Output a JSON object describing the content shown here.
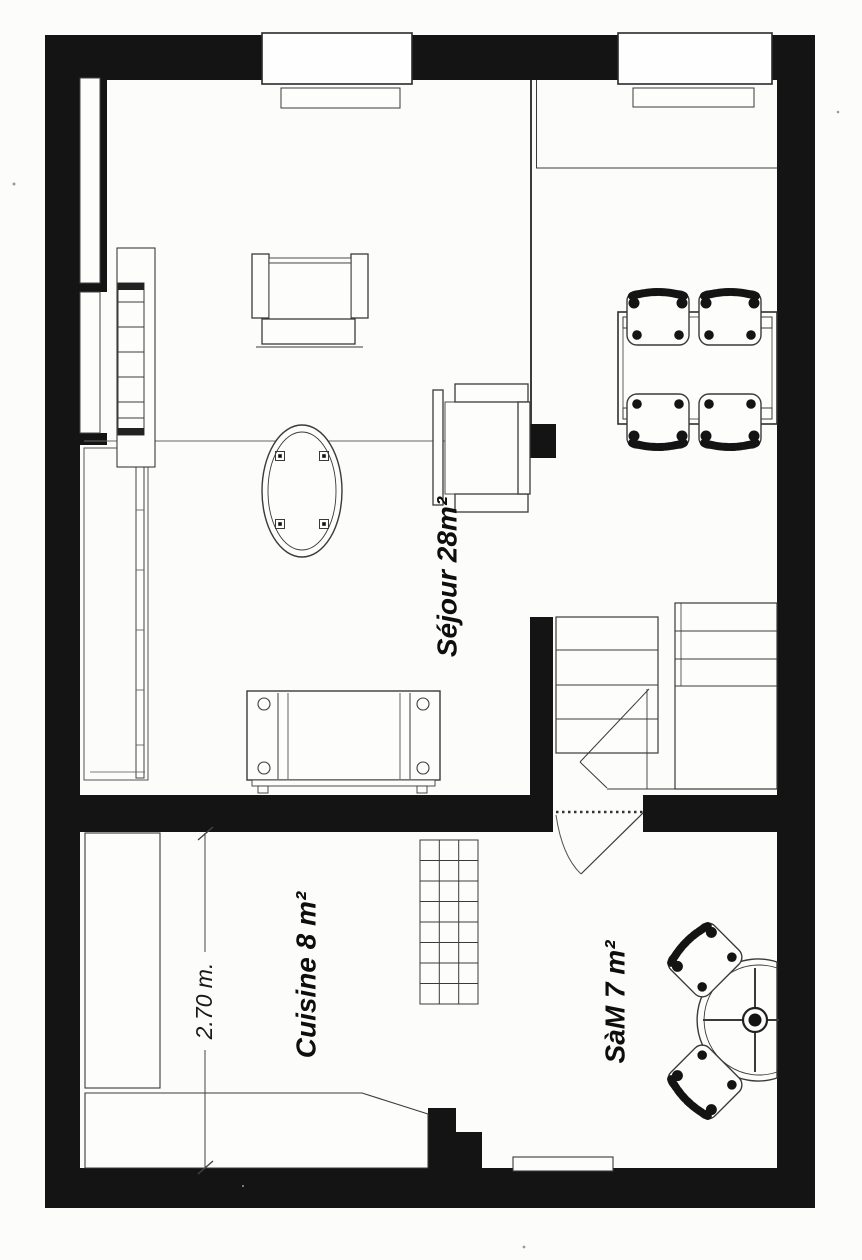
{
  "document": {
    "type": "architectural floor plan (scanned)",
    "ink_color": "#141414",
    "paper_color": "#fcfcfa"
  },
  "rooms": [
    {
      "id": "sejour",
      "label": "Séjour 28m²"
    },
    {
      "id": "cuisine",
      "label": "Cuisine 8 m²"
    },
    {
      "id": "sam",
      "label": "SàM 7 m²"
    }
  ],
  "dimensions": [
    {
      "id": "kitchen-width",
      "label": "2.70 m."
    }
  ]
}
